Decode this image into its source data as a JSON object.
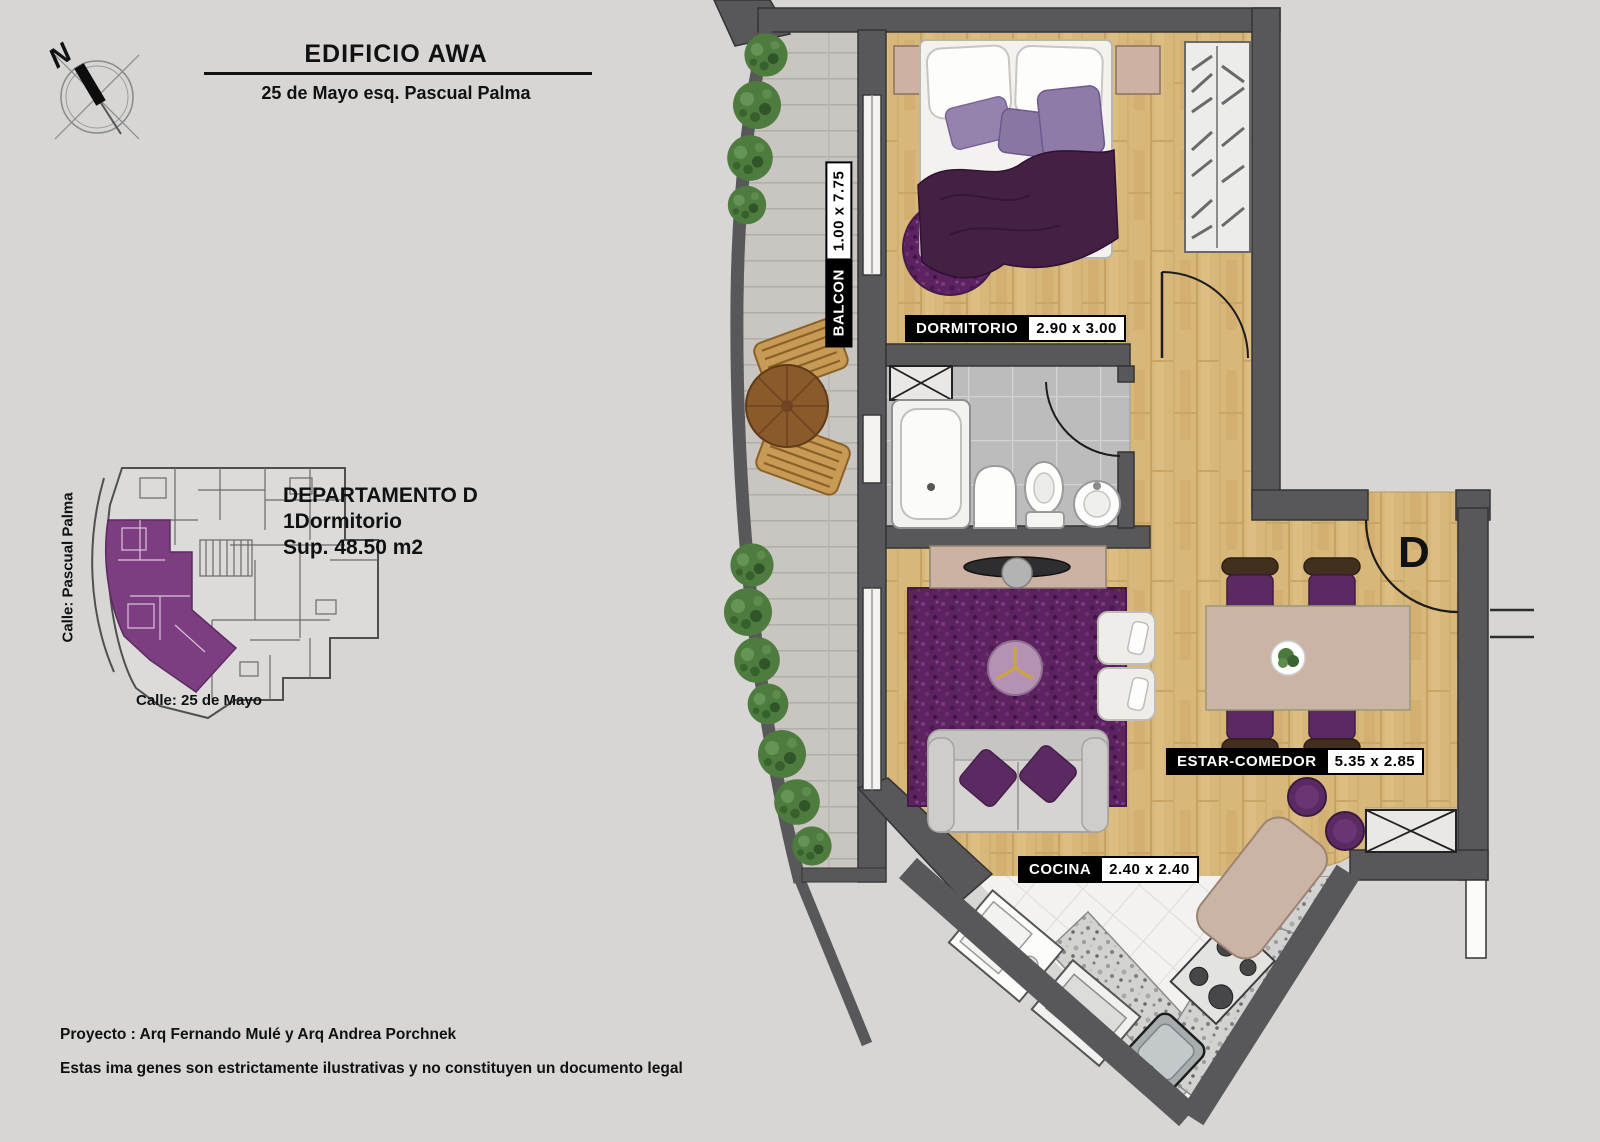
{
  "header": {
    "title": "EDIFICIO AWA",
    "subtitle": "25 de Mayo esq. Pascual Palma"
  },
  "compass": {
    "north_label": "N"
  },
  "key_plan": {
    "street_left": "Calle: Pascual Palma",
    "street_bottom": "Calle: 25 de Mayo",
    "highlight_color": "#7c3e80"
  },
  "unit_info": {
    "name": "DEPARTAMENTO D",
    "type": "1Dormitorio",
    "area": "Sup. 48.50 m2"
  },
  "plan": {
    "entrance_label": "D",
    "rooms": {
      "balcon": {
        "name": "BALCON",
        "dims": "1.00 x 7.75"
      },
      "dormitorio": {
        "name": "DORMITORIO",
        "dims": "2.90 x 3.00"
      },
      "estar_comedor": {
        "name": "ESTAR-COMEDOR",
        "dims": "5.35 x 2.85"
      },
      "cocina": {
        "name": "COCINA",
        "dims": "2.40 x 2.40"
      }
    },
    "colors": {
      "wall": "#58585a",
      "wood_floor": "#d8b77b",
      "rug_purple": "#5d2361",
      "balcony_tile": "#c9c5c0",
      "bath_tile": "#bcbcbc",
      "accent_purple": "#5b2a63",
      "greenery": "#4e7c3f"
    }
  },
  "footer": {
    "line1": "Proyecto : Arq Fernando Mulé y Arq Andrea Porchnek",
    "line2": "Estas ima genes son estrictamente ilustrativas y no constituyen un documento legal"
  }
}
